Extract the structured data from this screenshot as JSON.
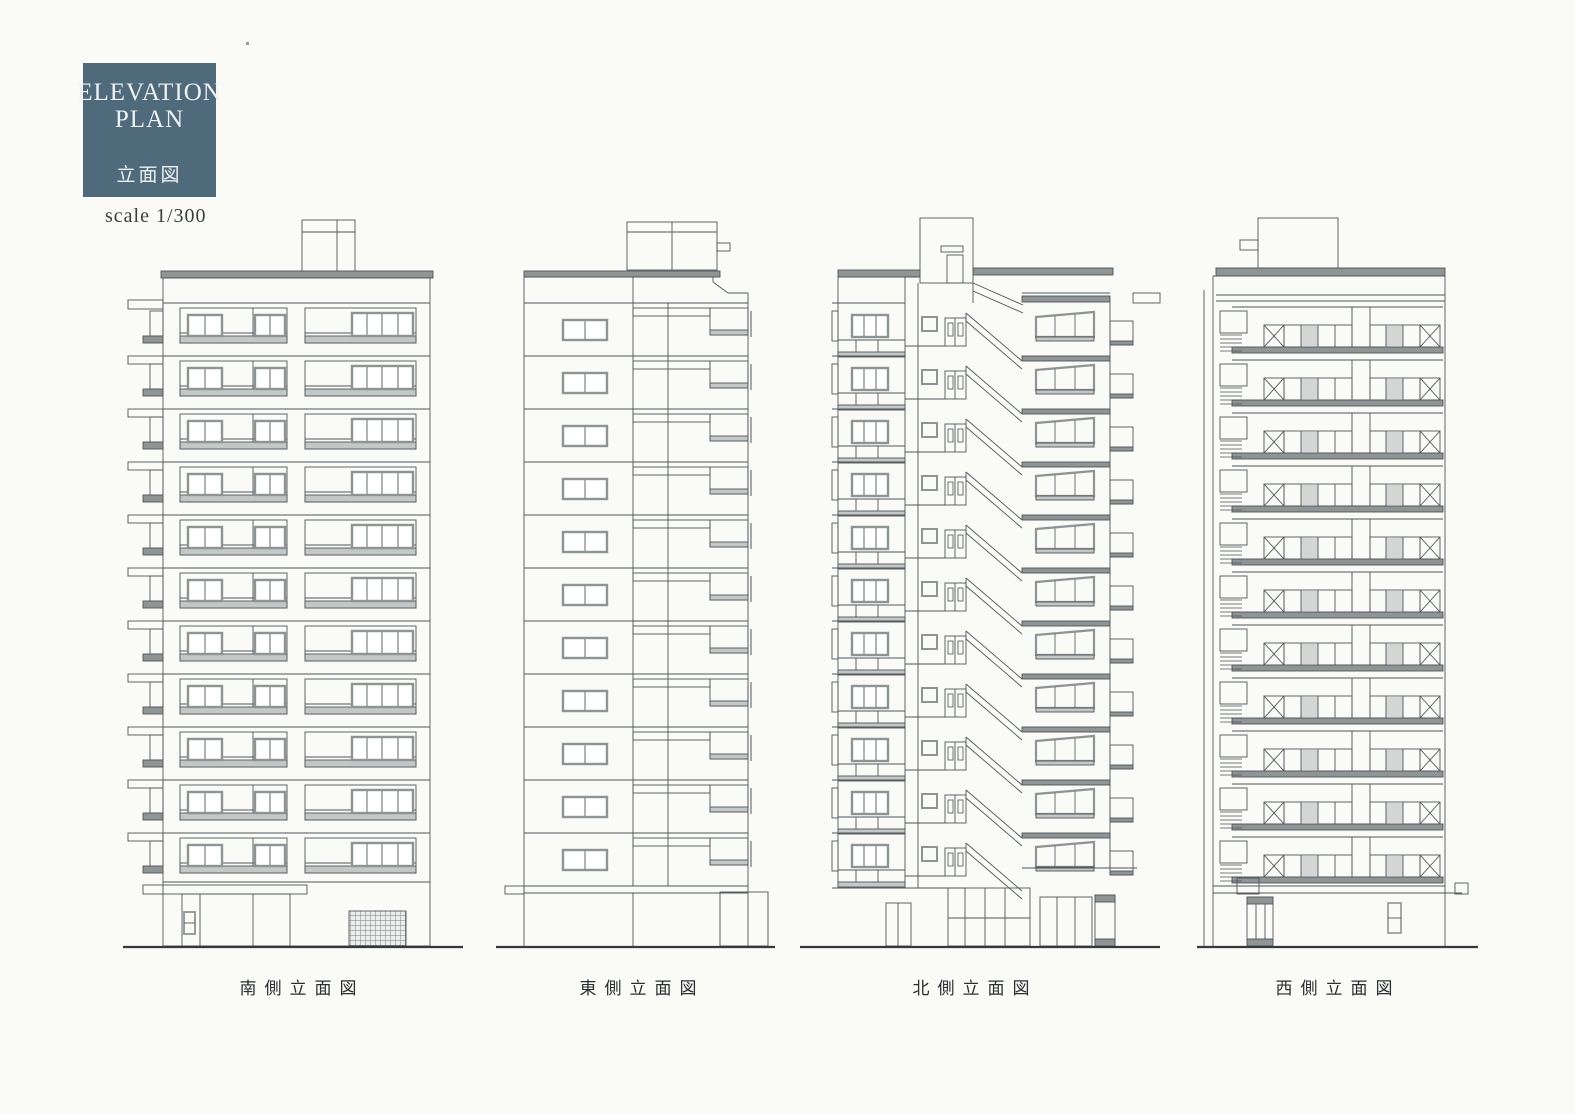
{
  "title_block": {
    "line1": "ELEVATION",
    "line2": "PLAN",
    "subtitle": "立面図"
  },
  "scale_label": "scale 1/300",
  "elevations": [
    {
      "id": "south",
      "label": "南側立面図",
      "floors": 11
    },
    {
      "id": "east",
      "label": "東側立面図",
      "floors": 11
    },
    {
      "id": "north",
      "label": "北側立面図",
      "floors": 11
    },
    {
      "id": "west",
      "label": "西側立面図",
      "floors": 11
    }
  ],
  "colors": {
    "title_bg": "#4e6a7b",
    "title_text": "#eef1f1",
    "ink": "#50565a",
    "slab_gray": "#8f9494",
    "railing_gray": "#c3c7c6",
    "window_frame": "#8e9394",
    "ground_ink": "#35393b",
    "paper": "#fafaf7"
  }
}
